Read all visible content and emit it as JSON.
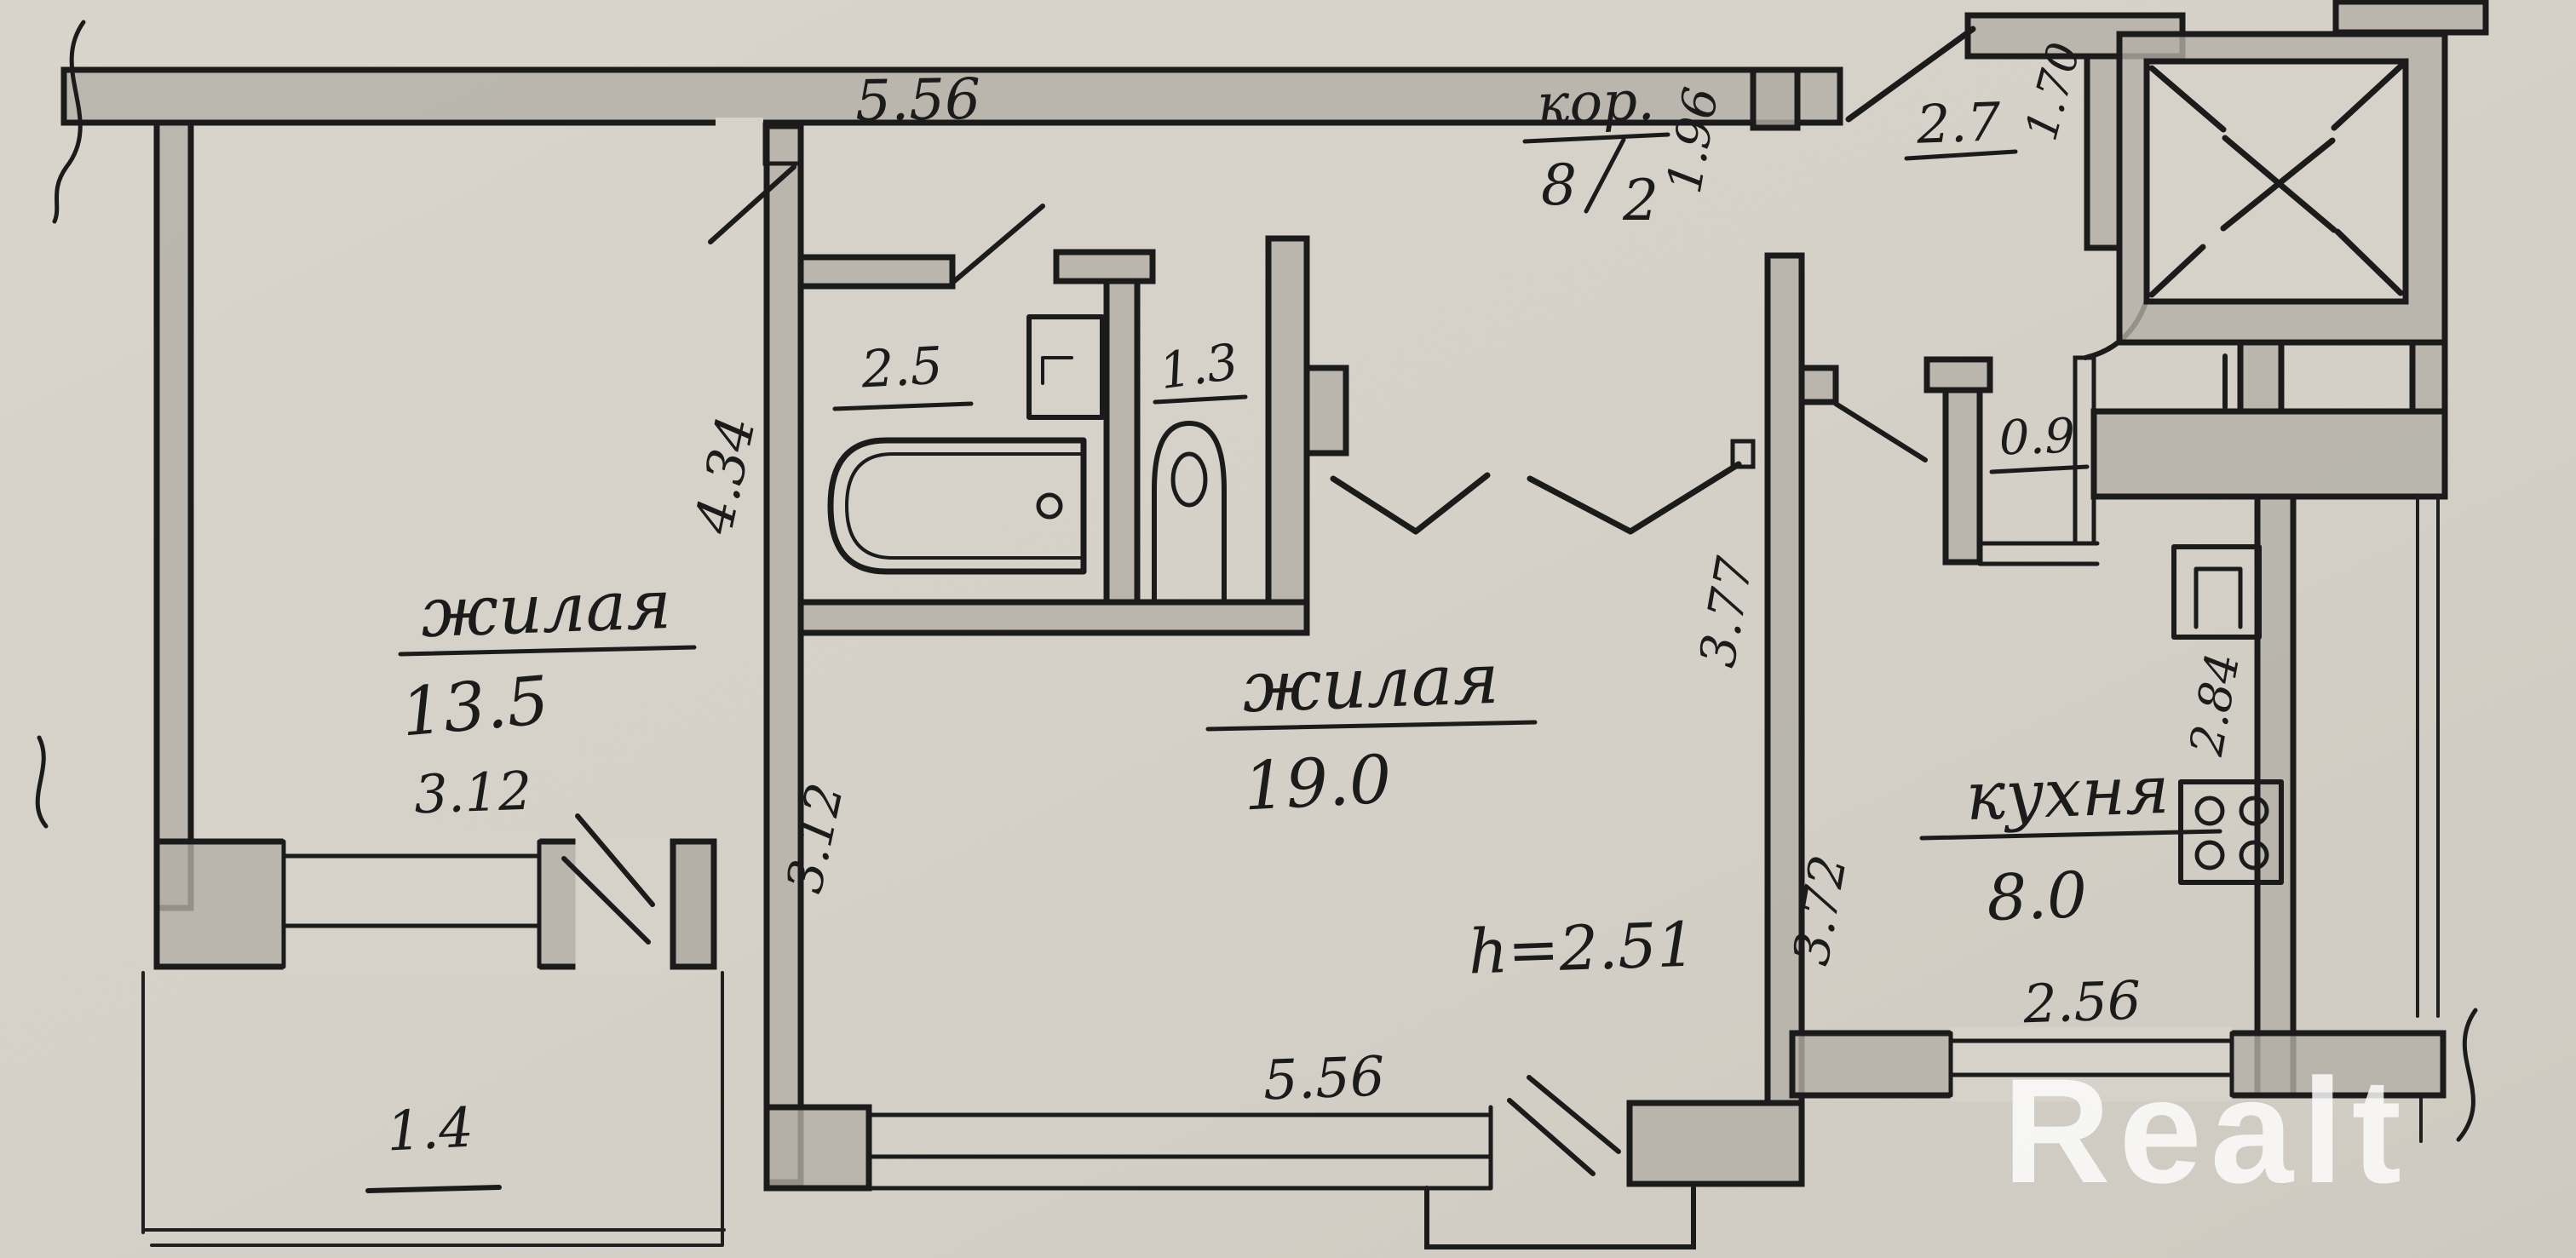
{
  "plan": {
    "type": "apartment-floor-plan",
    "paper_color": "#d6d2c9",
    "ink_color": "#1b1b1b",
    "pencil_color": "#b3afa6",
    "watermark": "Realt",
    "height_note": "h=2.51"
  },
  "rooms": {
    "living1": {
      "name": "жилая",
      "area": "13.5"
    },
    "living2": {
      "name": "жилая",
      "area": "19.0"
    },
    "corridor": {
      "name": "кор.",
      "area_num": "8",
      "area_den": "2"
    },
    "kitchen": {
      "name": "кухня",
      "area": "8.0"
    },
    "bathroom": {
      "area": "2.5"
    },
    "toilet": {
      "area": "1.3"
    },
    "hall": {
      "area": "2.7"
    },
    "closet": {
      "area": "0.9"
    },
    "balcony": {
      "area": "1.4"
    }
  },
  "dimensions": {
    "top_width": "5.56",
    "room1_depth": "4.34",
    "room1_width": "3.12",
    "room1_inner_depth": "3.12",
    "corridor_gap": "1.96",
    "hall_depth": "1.70",
    "wall_377": "3.77",
    "kitchen_depth": "3.72",
    "kitchen_right": "2.84",
    "kitchen_width": "2.56",
    "living2_width": "5.56"
  }
}
